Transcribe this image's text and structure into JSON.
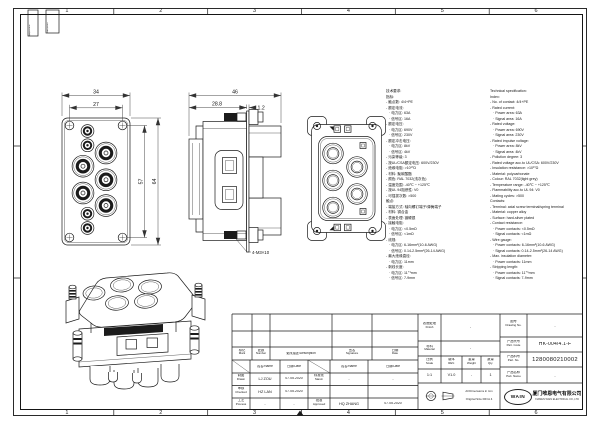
{
  "sheet": {
    "zone_numbers": [
      "1",
      "2",
      "3",
      "4",
      "5",
      "6"
    ],
    "corner_box_1": "拟制/Date",
    "corner_box_2": "更改/Rev."
  },
  "dimensions": {
    "front_width_outer": "34",
    "front_width_inner": "27",
    "front_height_inner": "57",
    "front_height_outer": "64",
    "side_width": "46",
    "side_depth": "28.8",
    "side_flange": "1.2",
    "screw_note": "4-M3×10"
  },
  "specs": {
    "cn_lines": [
      "技术要求:",
      "指标:",
      "- 触点数: 4/4+PE",
      "- 额定电流:",
      "   · 电力区: 63A",
      "   · 信号区: 16A",
      "- 额定电压:",
      "   · 电力区: 690V",
      "   · 信号区: 230V",
      "- 额定冲击电压:",
      "   · 电力区: 8kV",
      "   · 信号区: 4kV",
      "- 污染等级: 3",
      "- 按UL/CSA额定电压: 600V/230V",
      "- 绝缘电阻: >10¹⁰Ω",
      "- 材料: 聚碳酸酯",
      "- 颜色: RAL 7032(浅灰色)",
      "- 温度范围: -40℃ ~ +125℃",
      "- 按UL 94阻燃性: V0",
      "- 可插拔次数: >500",
      "触点:",
      "- 端接方式: 轴向螺钉端子/弹簧端子",
      "- 材料: 铜合金",
      "- 表面处理: 镀硬银",
      "- 接触电阻:",
      "   · 电力区: <0.5mΩ",
      "   · 信号区: <1mΩ",
      "- 线规:",
      "   · 电力区: 6-16mm²(10-6 AWG)",
      "   · 信号区: 0.14-2.5mm²(26-14 AWG)",
      "- 最大绝缘直径:",
      "   · 电力区: 11mm",
      "- 剥线长度:",
      "   · 电力区: 11⁺¹mm",
      "   · 信号区: 7-9mm"
    ],
    "en_lines": [
      "Technical specification:",
      "Index:",
      "- No. of contact: 4/4+PE",
      "- Rated current:",
      "   · Power area: 63A",
      "   · Signal area: 16A",
      "- Rated voltage:",
      "   · Power area: 690V",
      "   · Signal area: 230V",
      "- Rated impulse voltage:",
      "   · Power area: 8kV",
      "   · Signal area: 4kV",
      "- Pollution degree: 3",
      "- Rated voltage acc.to UL/CSA: 600V/230V",
      "- Insulation resistance: >10¹⁰Ω",
      "- Material: polycarbonate",
      "- Colour: RAL 7032(light grey)",
      "- Temperature range: -40℃ ~ +125℃",
      "- Flammability acc.to UL 94: V0",
      "- Mating cycles: >500",
      "Contacts:",
      "- Terminal: axial screw terminal/spring terminal",
      "- Material: copper alloy",
      "- Surface: hard-silver plated",
      "- Contact resistance:",
      "   · Power contacts: <0.5mΩ",
      "   · Signal contacts: <1mΩ",
      "- Wire gauge:",
      "   · Power contacts: 6-16mm²(10-6 AWG)",
      "   · Signal contacts: 0.14-2.5mm²(26-14 AWG)",
      "- Max. insulation diameter:",
      "   · Power contacts: 11mm",
      "- Stripping length:",
      "   · Power contacts: 11⁺¹mm",
      "   · Signal contacts: 7-9mm"
    ]
  },
  "title_block": {
    "mark": {
      "cn": "标记",
      "en": "Mark"
    },
    "number": {
      "cn": "处数",
      "en": "Number"
    },
    "description": "更改描述/Description",
    "signature": {
      "cn": "签名",
      "en": "Signature"
    },
    "date_h": {
      "cn": "日期",
      "en": "Date"
    },
    "name_h": "姓名/Name",
    "date_h2": "日期/Date",
    "name_h3": "姓名/Name",
    "date_h3": "日期/Date",
    "drawn": {
      "label": {
        "cn": "制图",
        "en": "Drawn"
      },
      "name": "LJ ZOU",
      "date": "07.05.2020"
    },
    "checked": {
      "label": {
        "cn": "审核",
        "en": "Checked"
      },
      "name": "HZ LAN",
      "date": "07.05.2020"
    },
    "process": {
      "label": {
        "cn": "工艺",
        "en": "Process"
      },
      "name": "-",
      "date": "-"
    },
    "stand": {
      "label": {
        "cn": "标准化",
        "en": "Stand."
      },
      "name": "-",
      "date": "-"
    },
    "approved": {
      "label": {
        "cn": "批准",
        "en": "Approved"
      },
      "name": "HQ ZHANG",
      "date": "07.05.2020"
    },
    "finish": {
      "label": {
        "cn": "表面处理",
        "en": "Finish"
      },
      "value": "-"
    },
    "material": {
      "label": {
        "cn": "材料",
        "en": "Material"
      },
      "value": "-"
    },
    "scale": {
      "label": {
        "cn": "比例",
        "en": "Scale"
      },
      "value": "1:1"
    },
    "rev": {
      "label": {
        "cn": "版本",
        "en": "REV."
      },
      "value": "V1.0"
    },
    "weight": {
      "label": {
        "cn": "重量",
        "en": "Weight"
      },
      "value": "-"
    },
    "qty": {
      "label": {
        "cn": "数量",
        "en": "Qty."
      },
      "value": "1"
    },
    "drawing_no": {
      "label": {
        "cn": "图号",
        "en": "Drawing No."
      },
      "value": "-"
    },
    "part_code": {
      "label": {
        "cn": "产品代号",
        "en": "Part. Code"
      },
      "value": "HK-004/4.1-F"
    },
    "part_no": {
      "label": {
        "cn": "产品料号",
        "en": "Part. No."
      },
      "value": "1280080210002"
    },
    "part_name": {
      "label": {
        "cn": "产品名称",
        "en": "Part. Name"
      },
      "value": "-"
    },
    "notes": {
      "line1": "All Dimensions in mm",
      "line2": "Original Size DIN A 4"
    },
    "company": {
      "logo": "WAIN",
      "cn": "厦门唯恩电气有限公司",
      "en": "XIAMEN WAIN ELECTRICAL CO.,LTD"
    }
  }
}
